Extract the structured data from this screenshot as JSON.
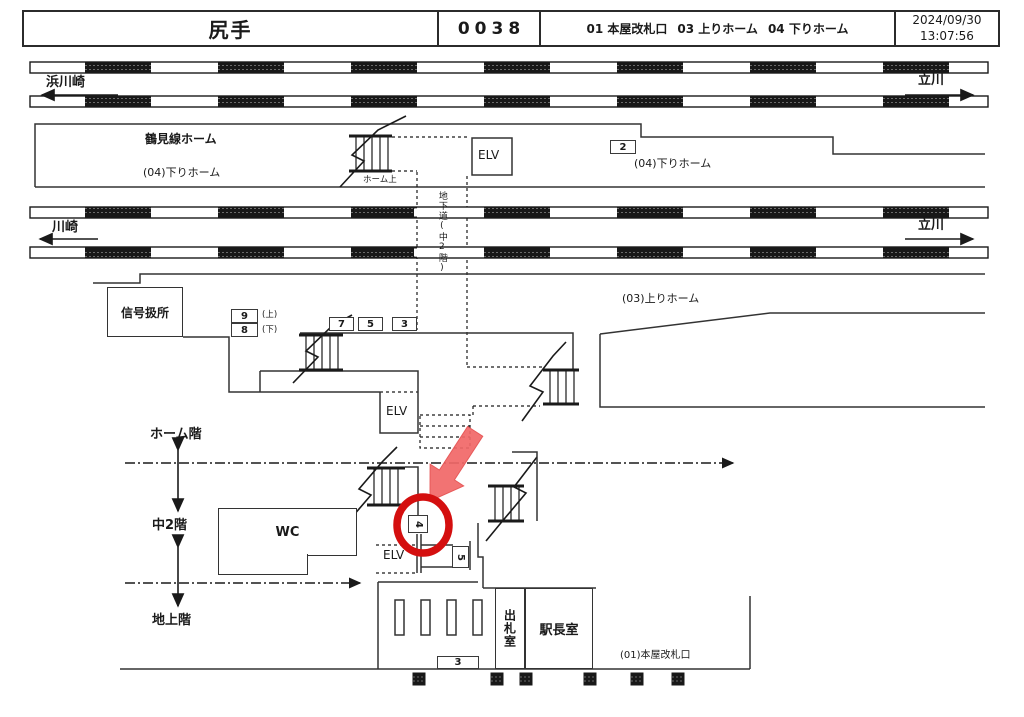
{
  "header": {
    "station": "尻手",
    "code": "0038",
    "exits": [
      "01 本屋改札口",
      "03 上りホーム",
      "04 下りホーム"
    ],
    "date": "2024/09/30",
    "time": "13:07:56"
  },
  "directions": {
    "top_left": "浜川崎",
    "top_right": "立川",
    "mid_left": "川崎",
    "mid_right": "立川"
  },
  "platform04": {
    "name": "鶴見線ホーム",
    "label_left": "(04)下りホーム",
    "label_right": "(04)下りホーム",
    "stair_label": "ホーム上",
    "elv": "ELV",
    "box2": "2"
  },
  "underpass": {
    "label": "地下道(中2階)"
  },
  "mezzanine": {
    "signal_box": "信号扱所",
    "box9": "9",
    "box9_note": "(上)",
    "box8": "8",
    "box8_note": "(下)",
    "box7": "7",
    "box5": "5",
    "box3": "3",
    "platform03_label": "(03)上りホーム",
    "elv": "ELV"
  },
  "levels": {
    "platform": "ホーム階",
    "mezzanine": "中2階",
    "ground": "地上階"
  },
  "ground": {
    "wc": "WC",
    "elv": "ELV",
    "box4": "4",
    "box5": "5",
    "box3": "3",
    "ticket_office": "出札室",
    "station_master": "駅長室",
    "gate_label": "(01)本屋改札口"
  },
  "colors": {
    "highlight_red": "#d40f0f",
    "arrow_red": "#f16868",
    "line_dark": "#1a1a1a"
  }
}
